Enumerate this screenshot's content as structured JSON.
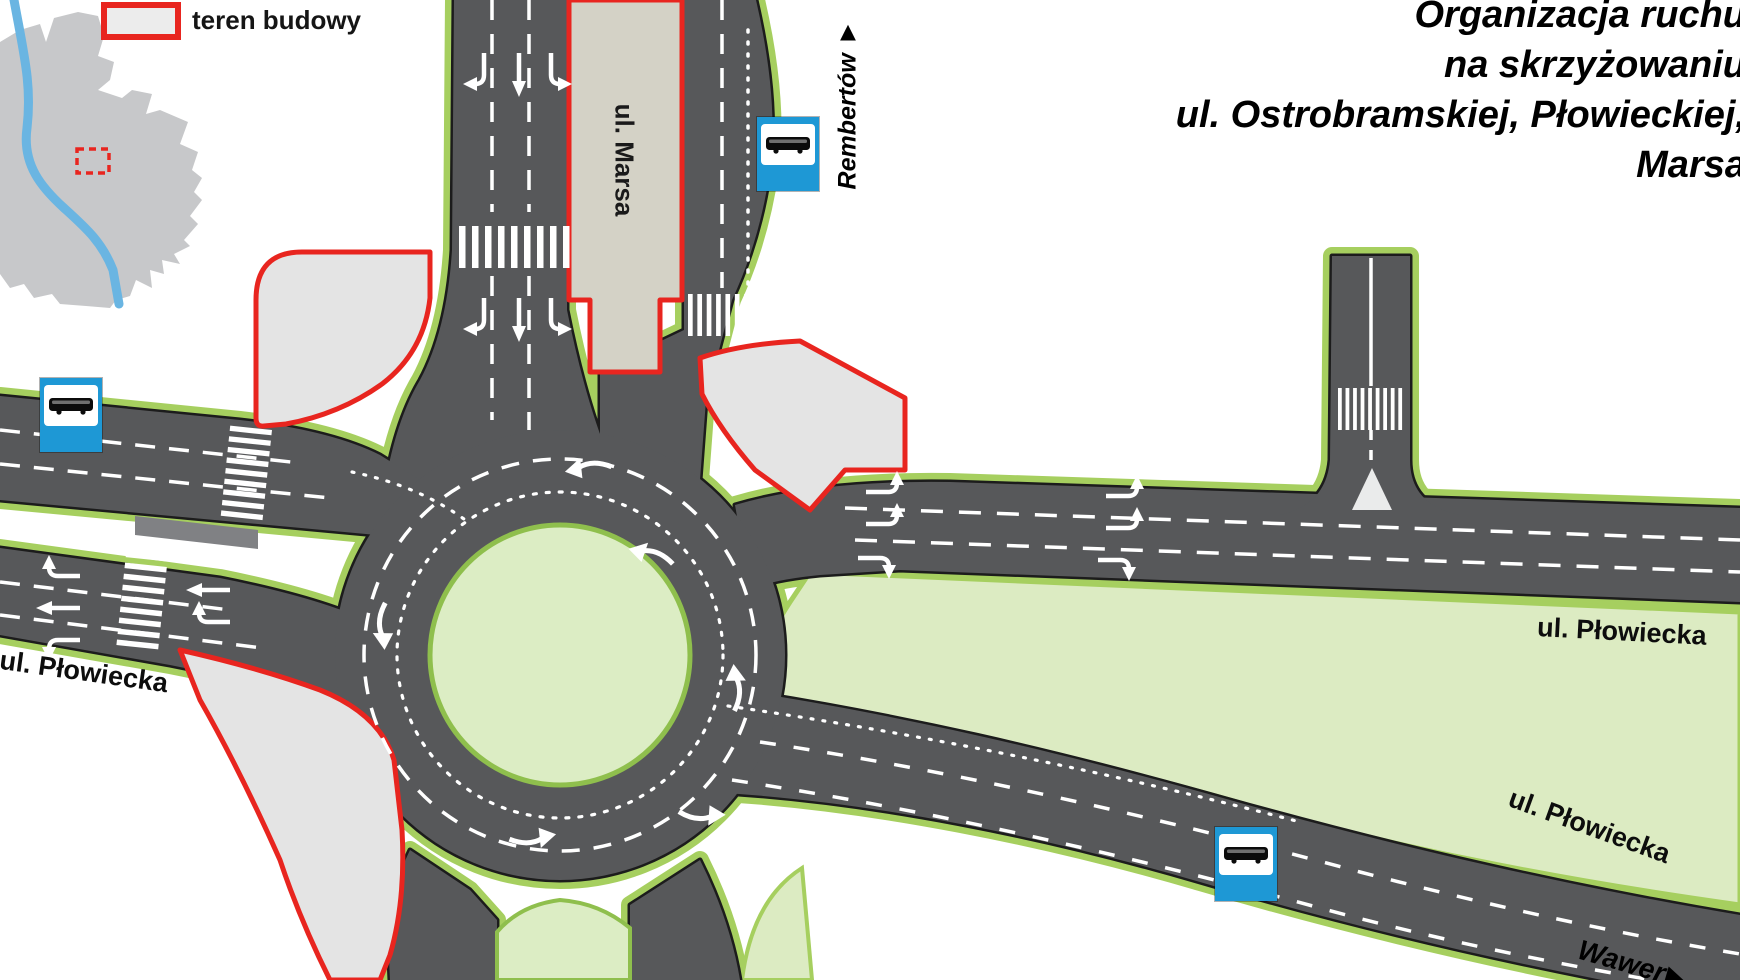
{
  "legend": {
    "construction_area_label": "teren budowy"
  },
  "title": {
    "line1": "Organizacja ruchu",
    "line2": "na skrzyżowaniu",
    "line3": "ul. Ostrobramskiej, Płowieckiej,",
    "line4": "Marsa"
  },
  "street_labels": {
    "marsa": "ul. Marsa",
    "plowiecka_west": "ul. Płowiecka",
    "plowiecka_east_upper": "ul. Płowiecka",
    "plowiecka_east_lower": "ul. Płowiecka"
  },
  "direction_labels": {
    "rembertow": {
      "name": "Rembertów",
      "arrow": "▲"
    },
    "wawer": {
      "name": "Wawer",
      "arrow": "▶"
    }
  },
  "icons": {
    "bus_stop": "bus-stop-sign",
    "location_marker": "construction-site-marker"
  },
  "colors": {
    "road": "#57585a",
    "road_outline": "#1c1c1c",
    "green_edge": "#a6cf5f",
    "green_fill": "#d9e7ad",
    "green_area": "#dcebc2",
    "island_fill": "#dcedc4",
    "construction_fill": "#e4e4e4",
    "construction_red": "#e8251f",
    "median_fill": "#d4d2c6",
    "bus_sign_blue": "#1e98d5",
    "marking_white": "#ffffff",
    "inset_city_gray": "#c7c8ca",
    "inset_river_blue": "#6ab5e2"
  }
}
